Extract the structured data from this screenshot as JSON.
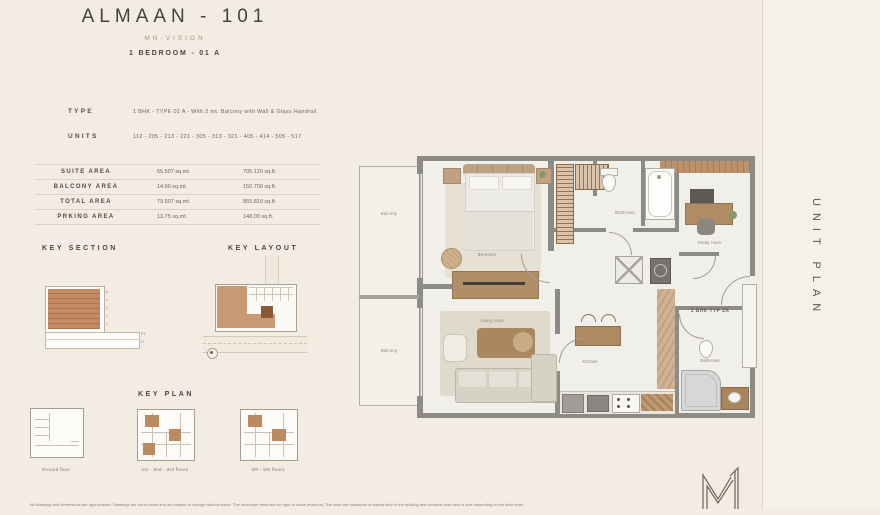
{
  "header": {
    "title": "ALMAAN - 101",
    "subtitle": "MN-VISION",
    "plan_name": "1 BEDROOM - 01 A"
  },
  "specs": {
    "type_label": "TYPE",
    "type_value": "1 BHK  -  TYPE 01 A  -  With 2 mt. Balcony with Wall & Glass Handrail",
    "units_label": "UNITS",
    "units_value": "112 - 205 - 213 - 221 - 305 - 313 - 321 - 405 - 414 - 505 - 517"
  },
  "area_table": {
    "rows": [
      {
        "label": "SUITE AREA",
        "sqmt": "65.507 sq.mt.",
        "sqft": "705.120 sq.ft."
      },
      {
        "label": "BALCONY AREA",
        "sqmt": "14.00 sq.mt.",
        "sqft": "150.700 sq.ft."
      },
      {
        "label": "TOTAL AREA",
        "sqmt": "79.507 sq.mt.",
        "sqft": "855.810 sq.ft."
      },
      {
        "label": "PRKING AREA",
        "sqmt": "13.75 sq.mt.",
        "sqft": "148.00 sq.ft."
      }
    ]
  },
  "key_section": {
    "heading": "KEY SECTION",
    "floor_labels": [
      "5",
      "4",
      "3",
      "2",
      "1"
    ],
    "podium_labels": [
      "P1",
      "G"
    ]
  },
  "key_layout": {
    "heading": "KEY LAYOUT"
  },
  "key_plan": {
    "heading": "KEY PLAN",
    "items": [
      {
        "caption": "Ground floor"
      },
      {
        "caption": "1st - 2nd - 3rd floors"
      },
      {
        "caption": "4th - 5th floors"
      }
    ]
  },
  "floor_plan": {
    "unit_tag": "1 BHK TYP 2A",
    "labels": {
      "balcony_upper": "Balcony",
      "balcony_lower": "Balcony",
      "bedroom": "Bedroom",
      "living_room": "Living room",
      "bathroom_upper": "Bathroom",
      "study_room": "Study room",
      "kitchen": "Kitchen",
      "bathroom_lower": "Bathroom"
    }
  },
  "side_panel": {
    "label": "UNIT PLAN"
  },
  "footer": {
    "disclaimer": "All drawings and dimensions are approximate. Drawings are not to scale and are subject to change without notice. The developer reserves the right to make revisions. The units are measured at typical floor in the building and columns may vary in size depending on the floor level."
  },
  "icons": {
    "logo": "mn-vision-m1-monogram"
  },
  "colors": {
    "background": "#f2ece2",
    "wall": "#8c8b86",
    "wood": "#b08c66",
    "section_brown": "#c28a62",
    "highlight_brown": "#8a5a38"
  }
}
